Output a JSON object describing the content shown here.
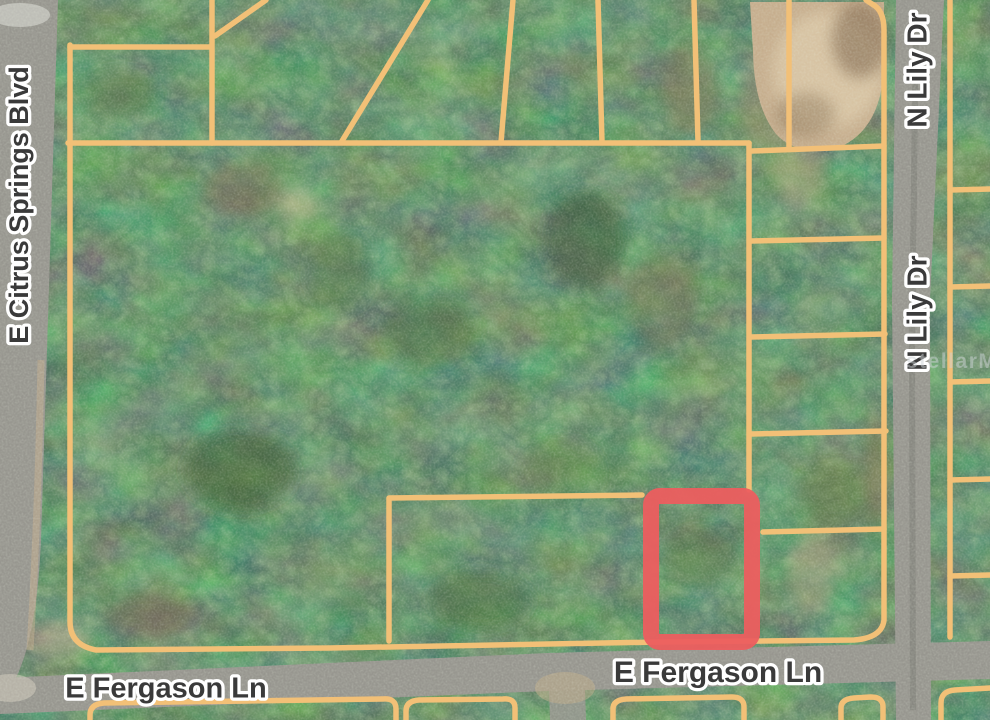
{
  "map": {
    "type": "aerial-parcel-map",
    "street_labels": {
      "left_vertical": "E Citrus Springs Blvd",
      "right_top_vertical": "N Lily Dr",
      "right_middle_vertical": "N Lily Dr",
      "bottom_left": "E Fergason Ln",
      "bottom_right": "E Fergason Ln"
    },
    "watermark": "stellarMLS",
    "highlighted_lot": {
      "x": 643,
      "y": 488,
      "width": 117,
      "height": 162
    },
    "colors": {
      "parcel_line": "#f2c077",
      "highlight_outline": "#ec5e5f",
      "road": "#97968f",
      "road_center": "#82817b",
      "forest_base": "#273522",
      "dirt": "#c6ae8e",
      "dirt_light": "#dcc9a9",
      "label_text": "#3a3a3a",
      "label_halo": "#ffffff",
      "watermark_color": "#cdd3d6"
    }
  }
}
